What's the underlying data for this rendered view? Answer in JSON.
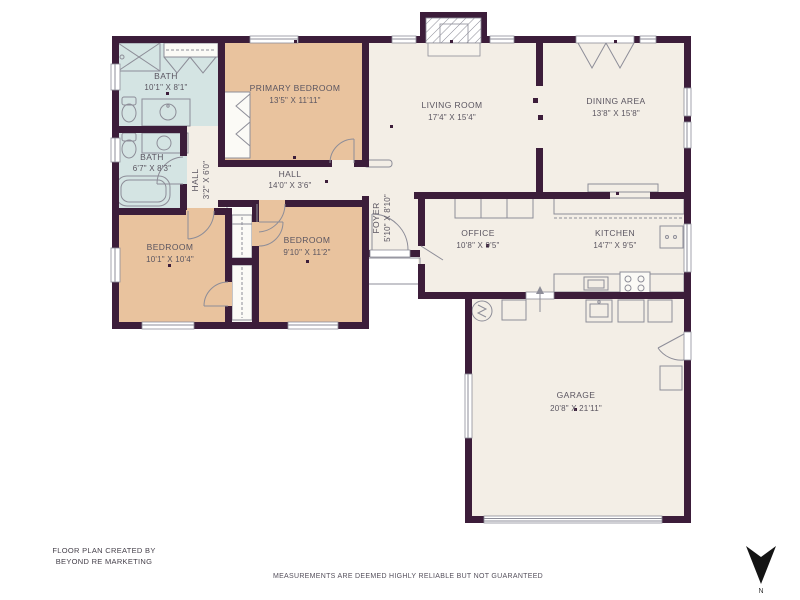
{
  "meta": {
    "credit_line1": "FLOOR PLAN CREATED BY",
    "credit_line2": "BEYOND RE MARKETING",
    "disclaimer": "MEASUREMENTS ARE DEEMED HIGHLY RELIABLE BUT NOT GUARANTEED",
    "compass_label": "N"
  },
  "colors": {
    "wall": "#3c1d3a",
    "floor": "#f3eee6",
    "bedroom_fill": "#e9c39e",
    "bath_fill": "#d4e4e3",
    "fixture_line": "#8d8d98",
    "label_text": "#5a5560"
  },
  "rooms": [
    {
      "id": "bath1",
      "name": "BATH",
      "dims": "10'1\" X 8'1\""
    },
    {
      "id": "primary_bedroom",
      "name": "PRIMARY BEDROOM",
      "dims": "13'5\" X 11'11\""
    },
    {
      "id": "living_room",
      "name": "LIVING ROOM",
      "dims": "17'4\" X 15'4\""
    },
    {
      "id": "dining_area",
      "name": "DINING AREA",
      "dims": "13'8\" X 15'8\""
    },
    {
      "id": "bath2",
      "name": "BATH",
      "dims": "6'7\" X 8'3\""
    },
    {
      "id": "hall_small",
      "name": "HALL",
      "dims": "3'2\" X 6'0\""
    },
    {
      "id": "hall",
      "name": "HALL",
      "dims": "14'0\" X 3'6\""
    },
    {
      "id": "foyer",
      "name": "FOYER",
      "dims": "5'10\" X 8'10\""
    },
    {
      "id": "office",
      "name": "OFFICE",
      "dims": "10'8\" X 9'5\""
    },
    {
      "id": "kitchen",
      "name": "KITCHEN",
      "dims": "14'7\" X 9'5\""
    },
    {
      "id": "bedroom_left",
      "name": "BEDROOM",
      "dims": "10'1\" X 10'4\""
    },
    {
      "id": "bedroom_right",
      "name": "BEDROOM",
      "dims": "9'10\" X 11'2\""
    },
    {
      "id": "garage",
      "name": "GARAGE",
      "dims": "20'8\" X 21'11\""
    }
  ]
}
